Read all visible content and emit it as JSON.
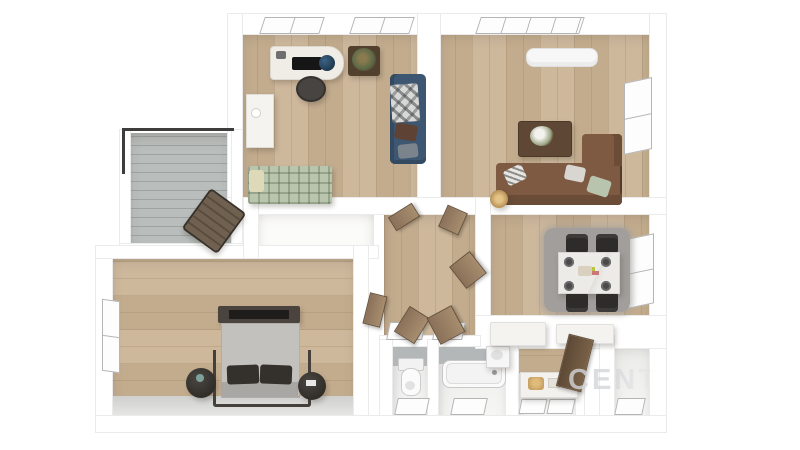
{
  "scene": {
    "type": "3d-floor-plan-render",
    "view": "top-down",
    "background": "#ffffff",
    "width": 800,
    "height": 450
  },
  "watermark": {
    "text": "CENT",
    "color_note": "faint light-gray overlay fading to the right"
  },
  "palette": {
    "wall": "#ffffff",
    "wall-edge": "#ebebeb",
    "wood-a": "#cdb89c",
    "wood-b": "#c3ac8e",
    "balcony-floor": "#b9bdbb",
    "tile": "#b3b7b8",
    "navy": "#3d5671",
    "brown-sofa": "#7d5a41",
    "brown-dark": "#6b4c37",
    "table-brown": "#5f4735",
    "daybed": "#bac5ae",
    "bed-gray": "#c3c1be",
    "frame-dark": "#46403a",
    "chair-black": "#2e2c2a",
    "marble": "#edebe8",
    "rug": "#a19e9b",
    "door-wood": "#8b7159",
    "door-edge": "#66513c",
    "railing": "#3e3d3b",
    "window-frame": "#b5b5b5",
    "watermark": "#d3d5d7"
  },
  "rooms": [
    {
      "id": "office",
      "furniture": [
        "desk",
        "desk-monitor",
        "desk-globe",
        "office-chair",
        "plant-stand",
        "dresser",
        "navy-sofa",
        "plaid-blanket",
        "daybed"
      ],
      "windows": 2
    },
    {
      "id": "living-room",
      "furniture": [
        "air-conditioner",
        "coffee-table",
        "sectional-sofa",
        "chaise",
        "pillows",
        "basket-lamp"
      ],
      "windows": 2
    },
    {
      "id": "balcony",
      "furniture": [
        "lounge-chair"
      ],
      "railing": true
    },
    {
      "id": "bedroom",
      "furniture": [
        "double-bed",
        "headboard-frame",
        "pillows",
        "nightstand-left",
        "nightstand-right"
      ],
      "windows": 1
    },
    {
      "id": "hallway",
      "furniture": [],
      "open_doors": 6
    },
    {
      "id": "dining-room",
      "furniture": [
        "dining-table",
        "dining-chair",
        "dining-chair",
        "dining-chair",
        "dining-chair",
        "rug",
        "place-settings"
      ],
      "windows": 1
    },
    {
      "id": "wc",
      "furniture": [
        "toilet"
      ],
      "windows": 1
    },
    {
      "id": "bathroom",
      "furniture": [
        "bathtub",
        "corner-sink"
      ],
      "windows": 1
    },
    {
      "id": "kitchen",
      "furniture": [
        "counter",
        "basket",
        "counter-left",
        "counter-right",
        "open-door"
      ],
      "windows": 2
    },
    {
      "id": "utility-room",
      "furniture": [],
      "windows": 1
    },
    {
      "id": "closet-nook",
      "furniture": [],
      "windows": 0
    }
  ]
}
